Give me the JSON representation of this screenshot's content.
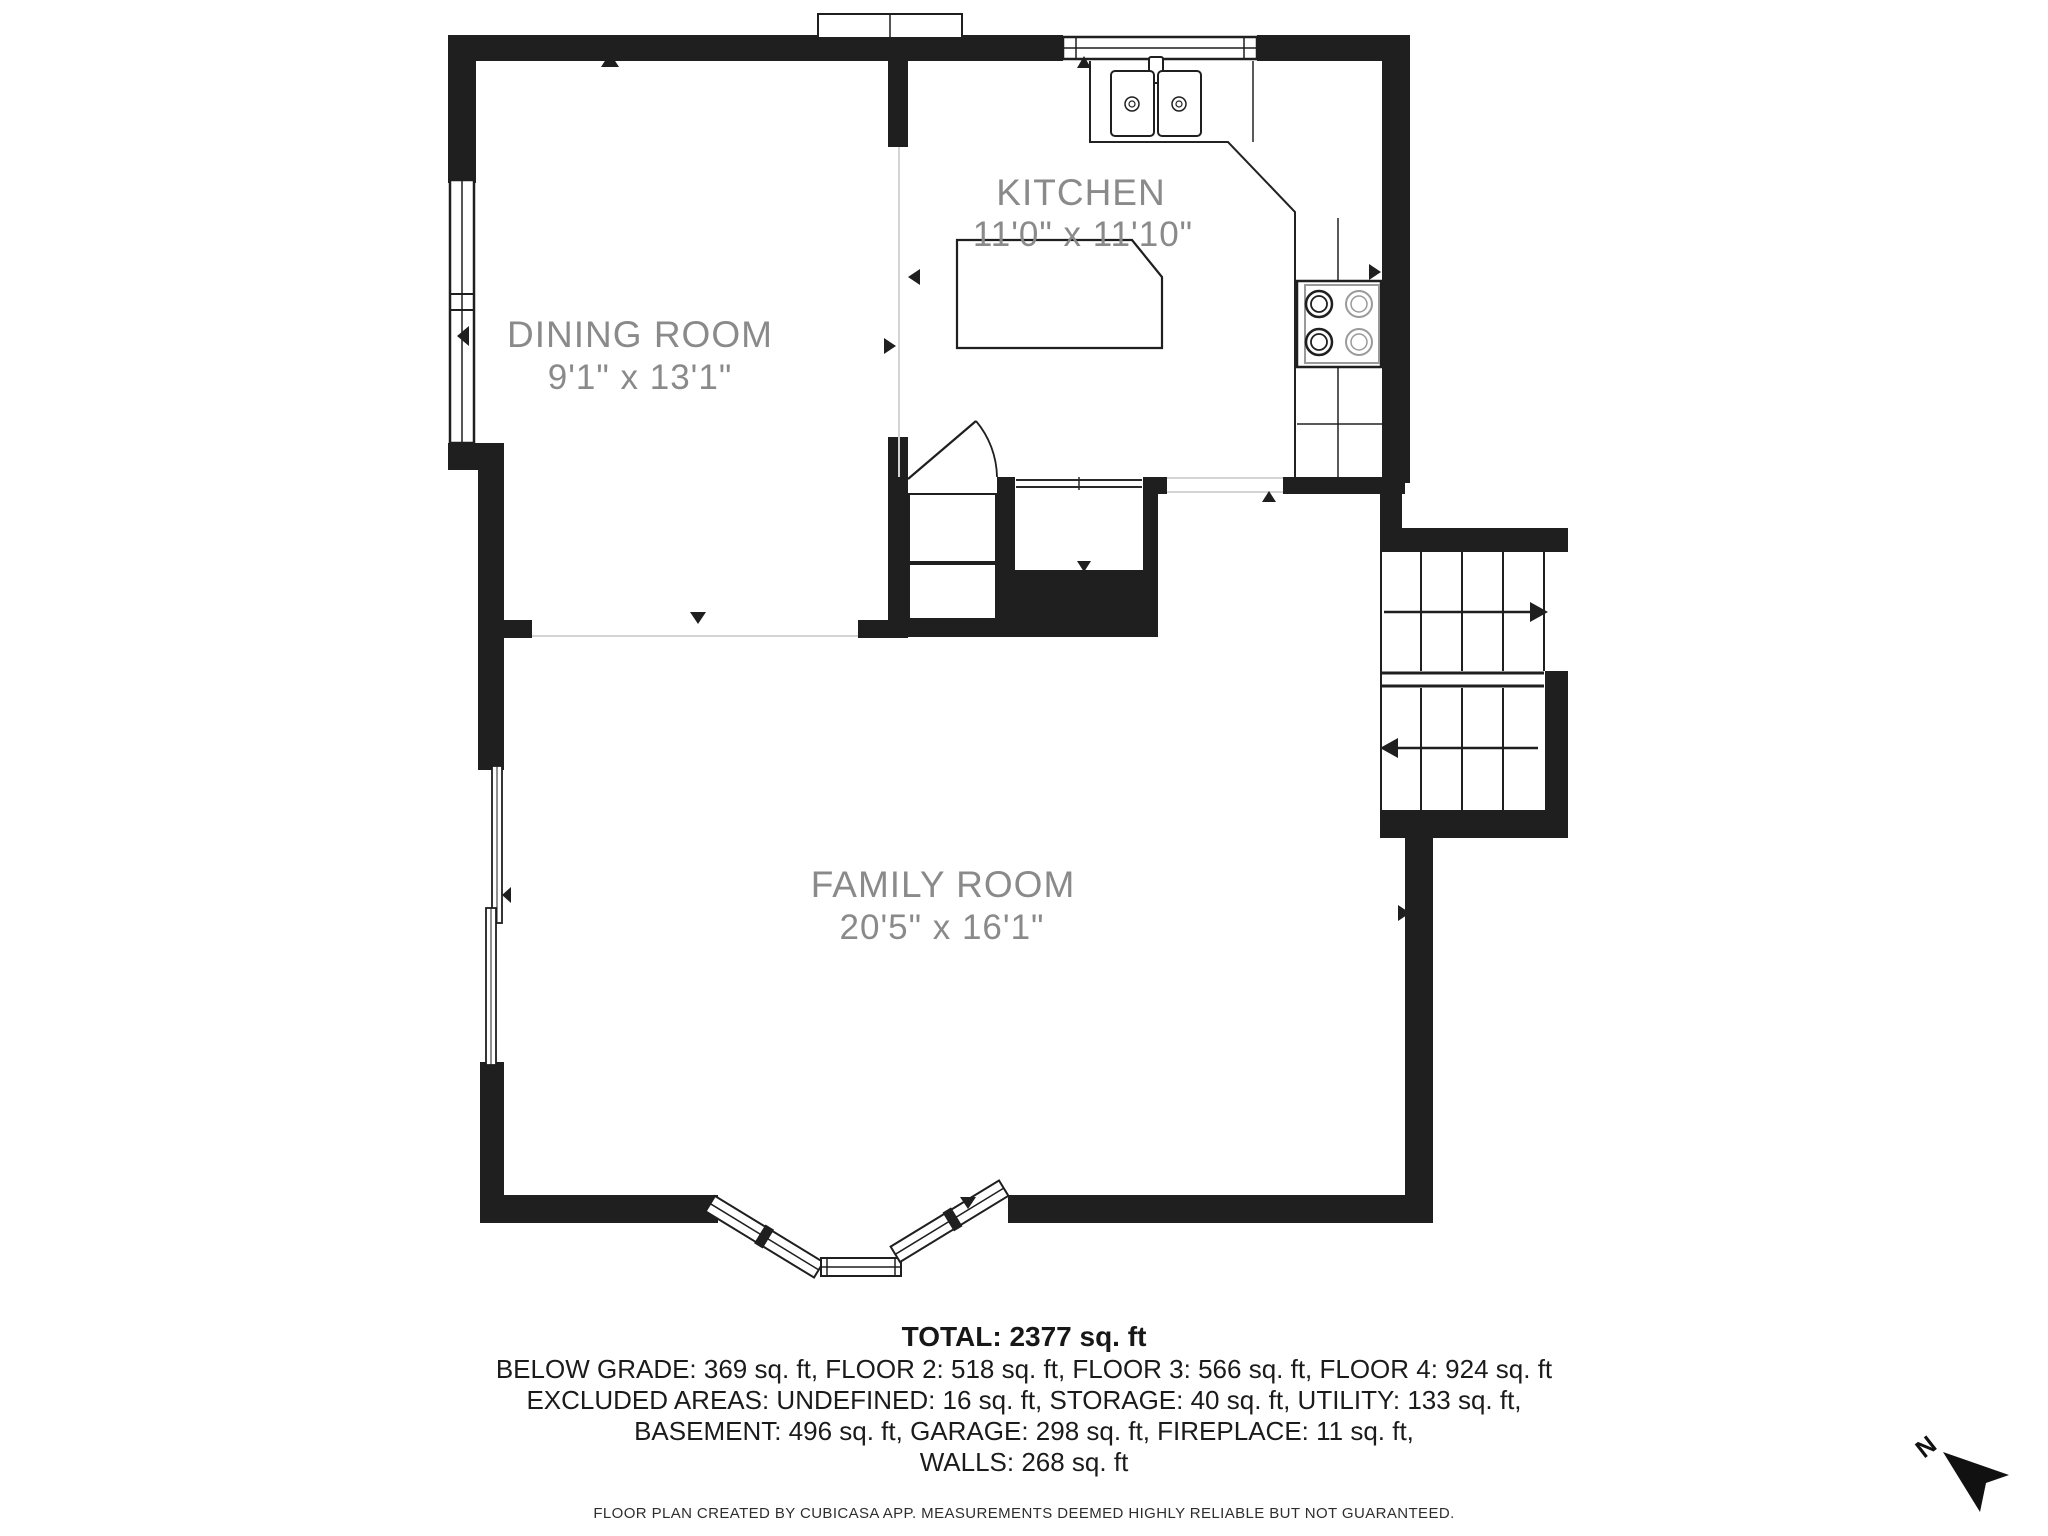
{
  "plan": {
    "rooms": [
      {
        "name": "DINING ROOM",
        "dims": "9'1\" x 13'1\""
      },
      {
        "name": "KITCHEN",
        "dims": "11'0\" x 11'10\""
      },
      {
        "name": "FAMILY ROOM",
        "dims": "20'5\" x 16'1\""
      }
    ],
    "compass": "N"
  },
  "summary": {
    "total": "TOTAL: 2377 sq. ft",
    "lines": [
      "BELOW GRADE: 369 sq. ft, FLOOR 2: 518 sq. ft, FLOOR 3: 566 sq. ft, FLOOR 4: 924 sq. ft",
      "EXCLUDED AREAS: UNDEFINED: 16 sq. ft, STORAGE: 40 sq. ft, UTILITY: 133 sq. ft,",
      "BASEMENT: 496 sq. ft, GARAGE: 298 sq. ft, FIREPLACE: 11 sq. ft,",
      "WALLS: 268 sq. ft"
    ]
  },
  "footer": {
    "disclaimer": "FLOOR PLAN CREATED BY CUBICASA APP. MEASUREMENTS DEEMED HIGHLY RELIABLE BUT NOT GUARANTEED."
  },
  "colors": {
    "wall": "#1f1f1f",
    "label": "#8a8a8a"
  }
}
